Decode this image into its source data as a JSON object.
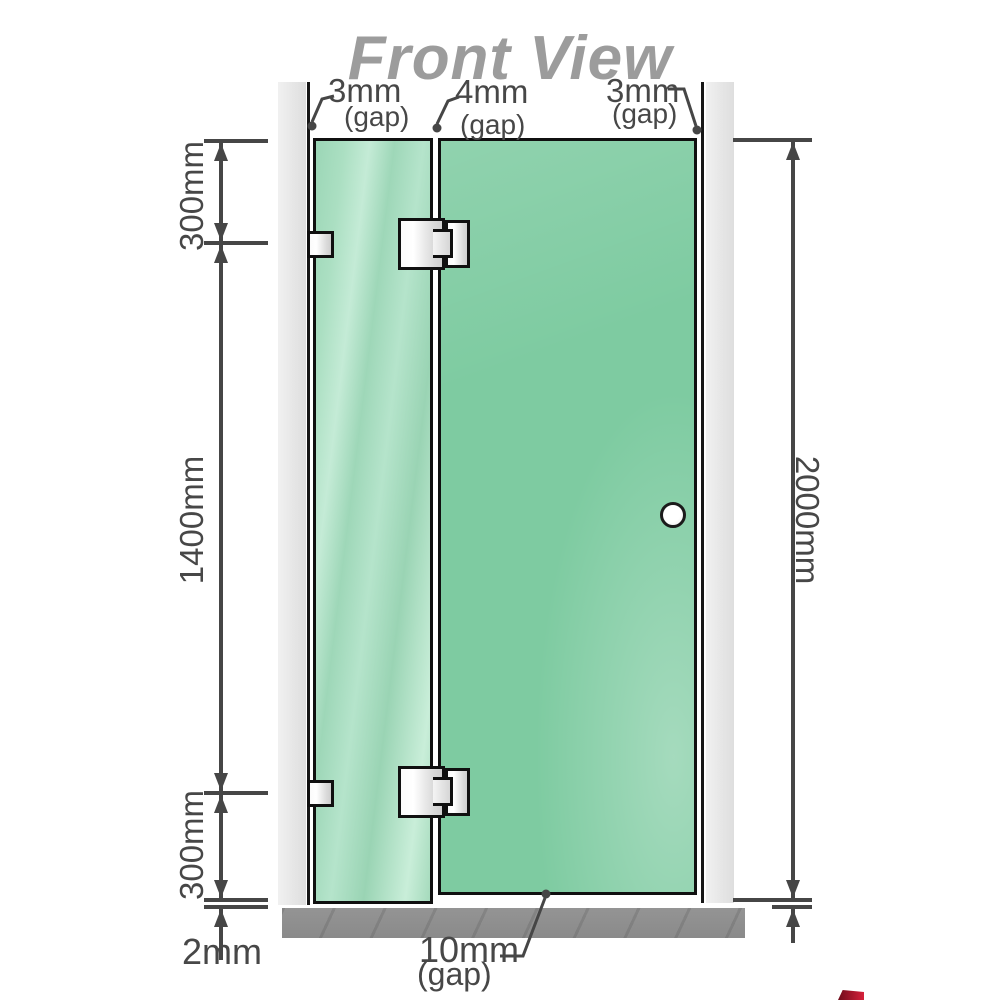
{
  "diagram": {
    "title": "Front View",
    "top_gaps": [
      {
        "value": "3mm",
        "label": "(gap)"
      },
      {
        "value": "4mm",
        "label": "(gap)"
      },
      {
        "value": "3mm",
        "label": "(gap)"
      }
    ],
    "left_dimensions": {
      "top_segment": "300mm",
      "middle_segment": "1400mm",
      "bottom_segment": "300mm",
      "floor_clearance": "2mm"
    },
    "right_dimensions": {
      "total_height": "2000mm"
    },
    "bottom_gap": {
      "value": "10mm",
      "label": "(gap)"
    }
  },
  "colors": {
    "glass_fixed_panel": "#aadec2",
    "glass_door_panel": "#7ecba1",
    "wall": "#e8e8e8",
    "floor": "#8e8e8e",
    "outline": "#101010",
    "dimension_line": "#464646",
    "label_text": "#474747",
    "title_text": "#9c9c9c",
    "hardware": "#e8e8e8",
    "corner_mark_red": "#c01a31"
  }
}
